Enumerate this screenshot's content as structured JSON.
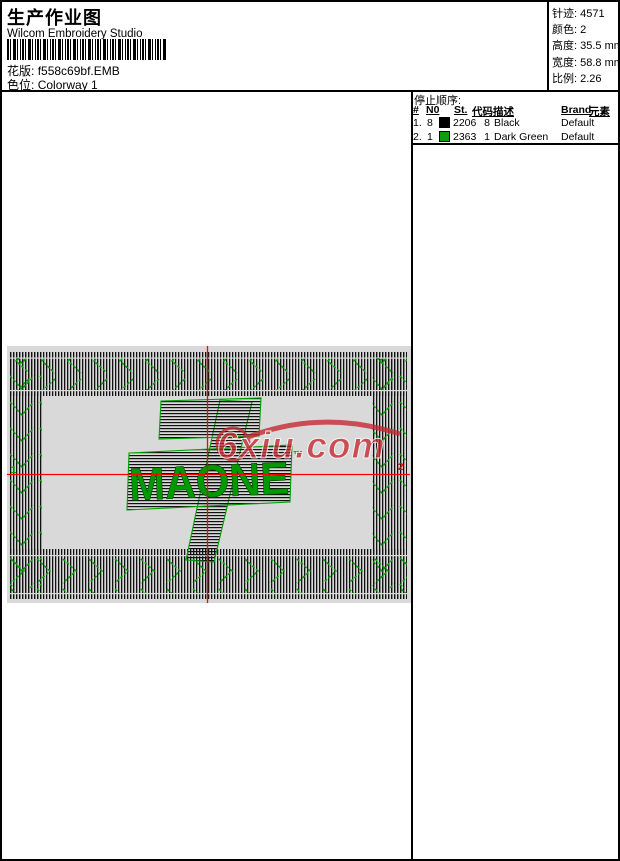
{
  "header": {
    "title": "生产作业图",
    "app_name": "Wilcom Embroidery Studio",
    "design_label": "花版:",
    "design_file": "f558c69bf.EMB",
    "colorway_label": "色位:",
    "colorway_value": "Colorway 1"
  },
  "stats": {
    "stitches_label": "针迹:",
    "stitches": "4571",
    "colors_label": "颜色:",
    "colors": "2",
    "height_label": "高度:",
    "height": "35.5 mm",
    "width_label": "宽度:",
    "width": "58.8 mm",
    "scale_label": "比例:",
    "scale": "2.26"
  },
  "stop_sequence": {
    "title": "停止顺序:",
    "headers": {
      "num": "#",
      "needle": "N0",
      "st": "St.",
      "code": "代码",
      "desc": "描述",
      "brand": "Brand",
      "element": "元素"
    },
    "rows": [
      {
        "seq": "1.",
        "needle": "8",
        "swatch": "#000000",
        "st": "2206",
        "code": "8",
        "desc": "Black",
        "brand": "Default"
      },
      {
        "seq": "2.",
        "needle": "1",
        "swatch": "#0f9e0f",
        "st": "2363",
        "code": "1",
        "desc": "Dark Green",
        "brand": "Default"
      }
    ]
  },
  "design": {
    "logo_text": "MAONE",
    "trademark": "™",
    "watermark": "6xiu.com",
    "start_marker": "1",
    "end_marker": "2",
    "colors": {
      "stitch_black": "#000000",
      "stitch_green": "#00a000",
      "crosshair": "#ff0000",
      "canvas": "#d9d9d9",
      "watermark_red": "#c52730"
    }
  }
}
